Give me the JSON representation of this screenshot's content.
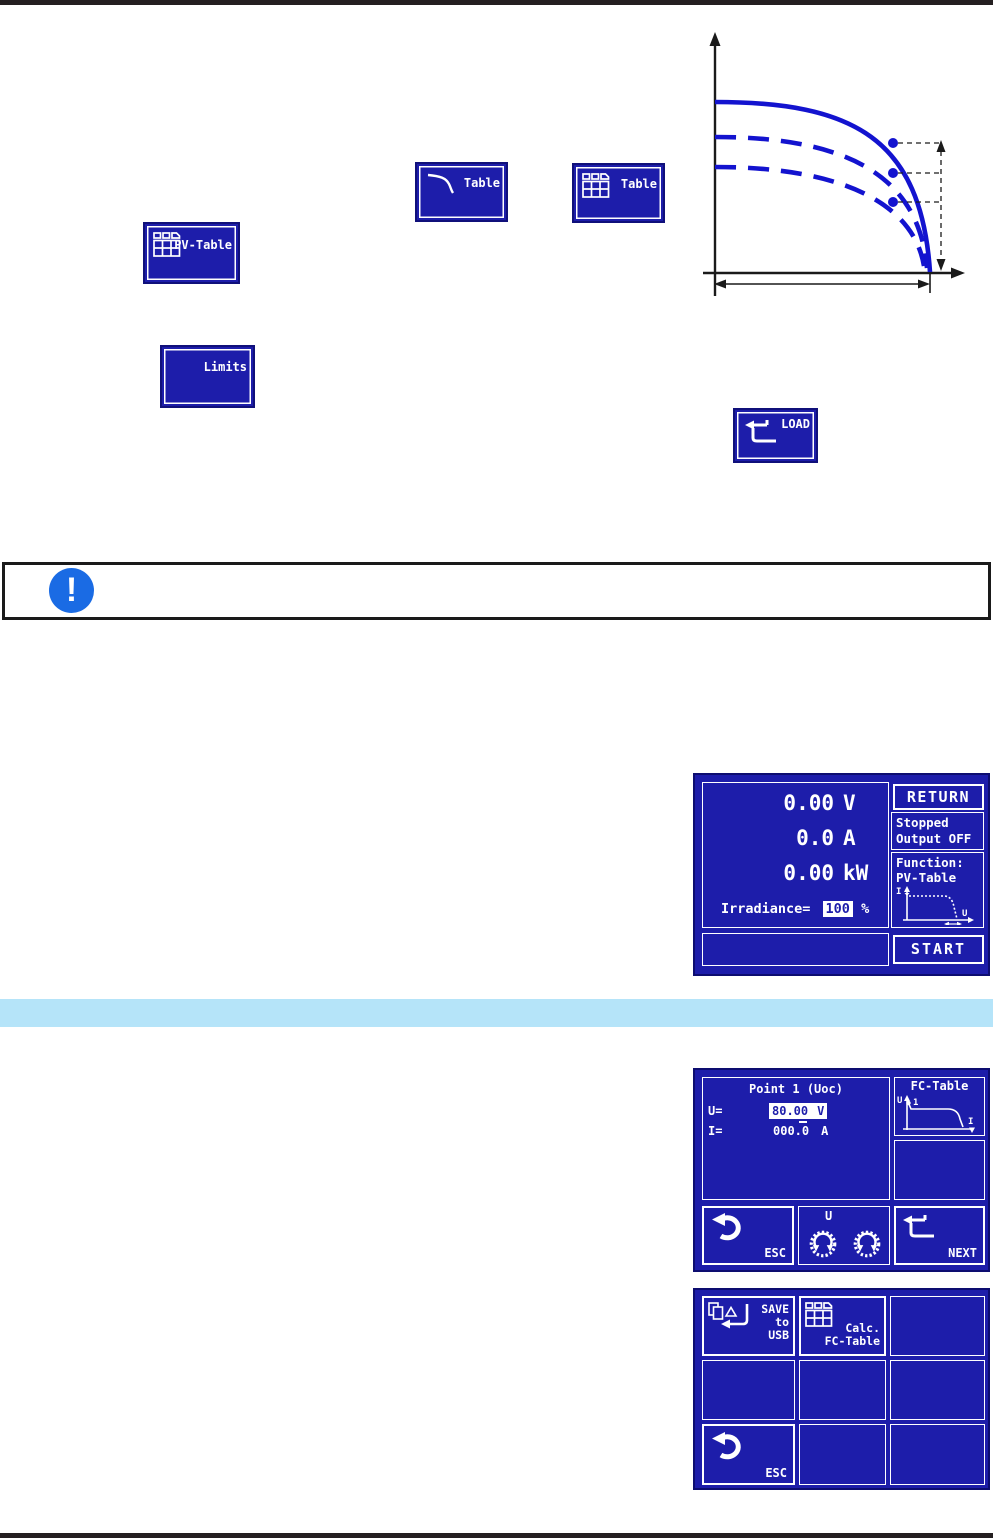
{
  "buttons": {
    "xy_table": {
      "line1": "XY-",
      "line2": "Table"
    },
    "pv_table": {
      "line1": "PV-",
      "line2": "Table"
    },
    "calc_pv_table": {
      "line1": "Calc.",
      "line2": "PV-Table"
    },
    "up_limits": {
      "line1": "U/P",
      "line2": "Limits"
    },
    "load": {
      "label": "LOAD"
    }
  },
  "notice": {
    "glyph": "!"
  },
  "screen_pv": {
    "voltage_value": "0.00",
    "voltage_unit": "V",
    "current_value": "0.0",
    "current_unit": "A",
    "power_value": "0.00",
    "power_unit": "kW",
    "irradiance_label": "Irradiance=",
    "irradiance_value": "100",
    "irradiance_unit": "%",
    "return_label": "RETURN",
    "status_line1": "Stopped",
    "status_line2": "Output OFF",
    "function_label": "Function:",
    "function_name": "PV-Table",
    "function_icon_y": "I",
    "function_icon_x": "U",
    "start_label": "START"
  },
  "screen_fc_point": {
    "title": "Point 1 (Uoc)",
    "u_label": "U=",
    "u_value": "80.00",
    "u_unit": "V",
    "i_label": "I=",
    "i_value": "000.0",
    "i_unit": "A",
    "fc_table_label": "FC-Table",
    "fc_icon_y": "U",
    "fc_icon_point": "1",
    "fc_icon_x": "I",
    "esc_label": "ESC",
    "knob_label": "U",
    "next_label": "NEXT"
  },
  "screen_fc_menu": {
    "save_line1": "SAVE",
    "save_line2": "to",
    "save_line3": "USB",
    "calc_line1": "Calc.",
    "calc_line2": "FC-Table",
    "esc_label": "ESC"
  },
  "colors": {
    "panel_blue": "#1d1daa",
    "panel_border_navy": "#10107a",
    "lcd_white": "#ffffff",
    "curve_blue": "#1313cf",
    "notice_blue": "#1a6be4",
    "section_bar_blue": "#b5e4f9",
    "rule_dark": "#241f21"
  }
}
